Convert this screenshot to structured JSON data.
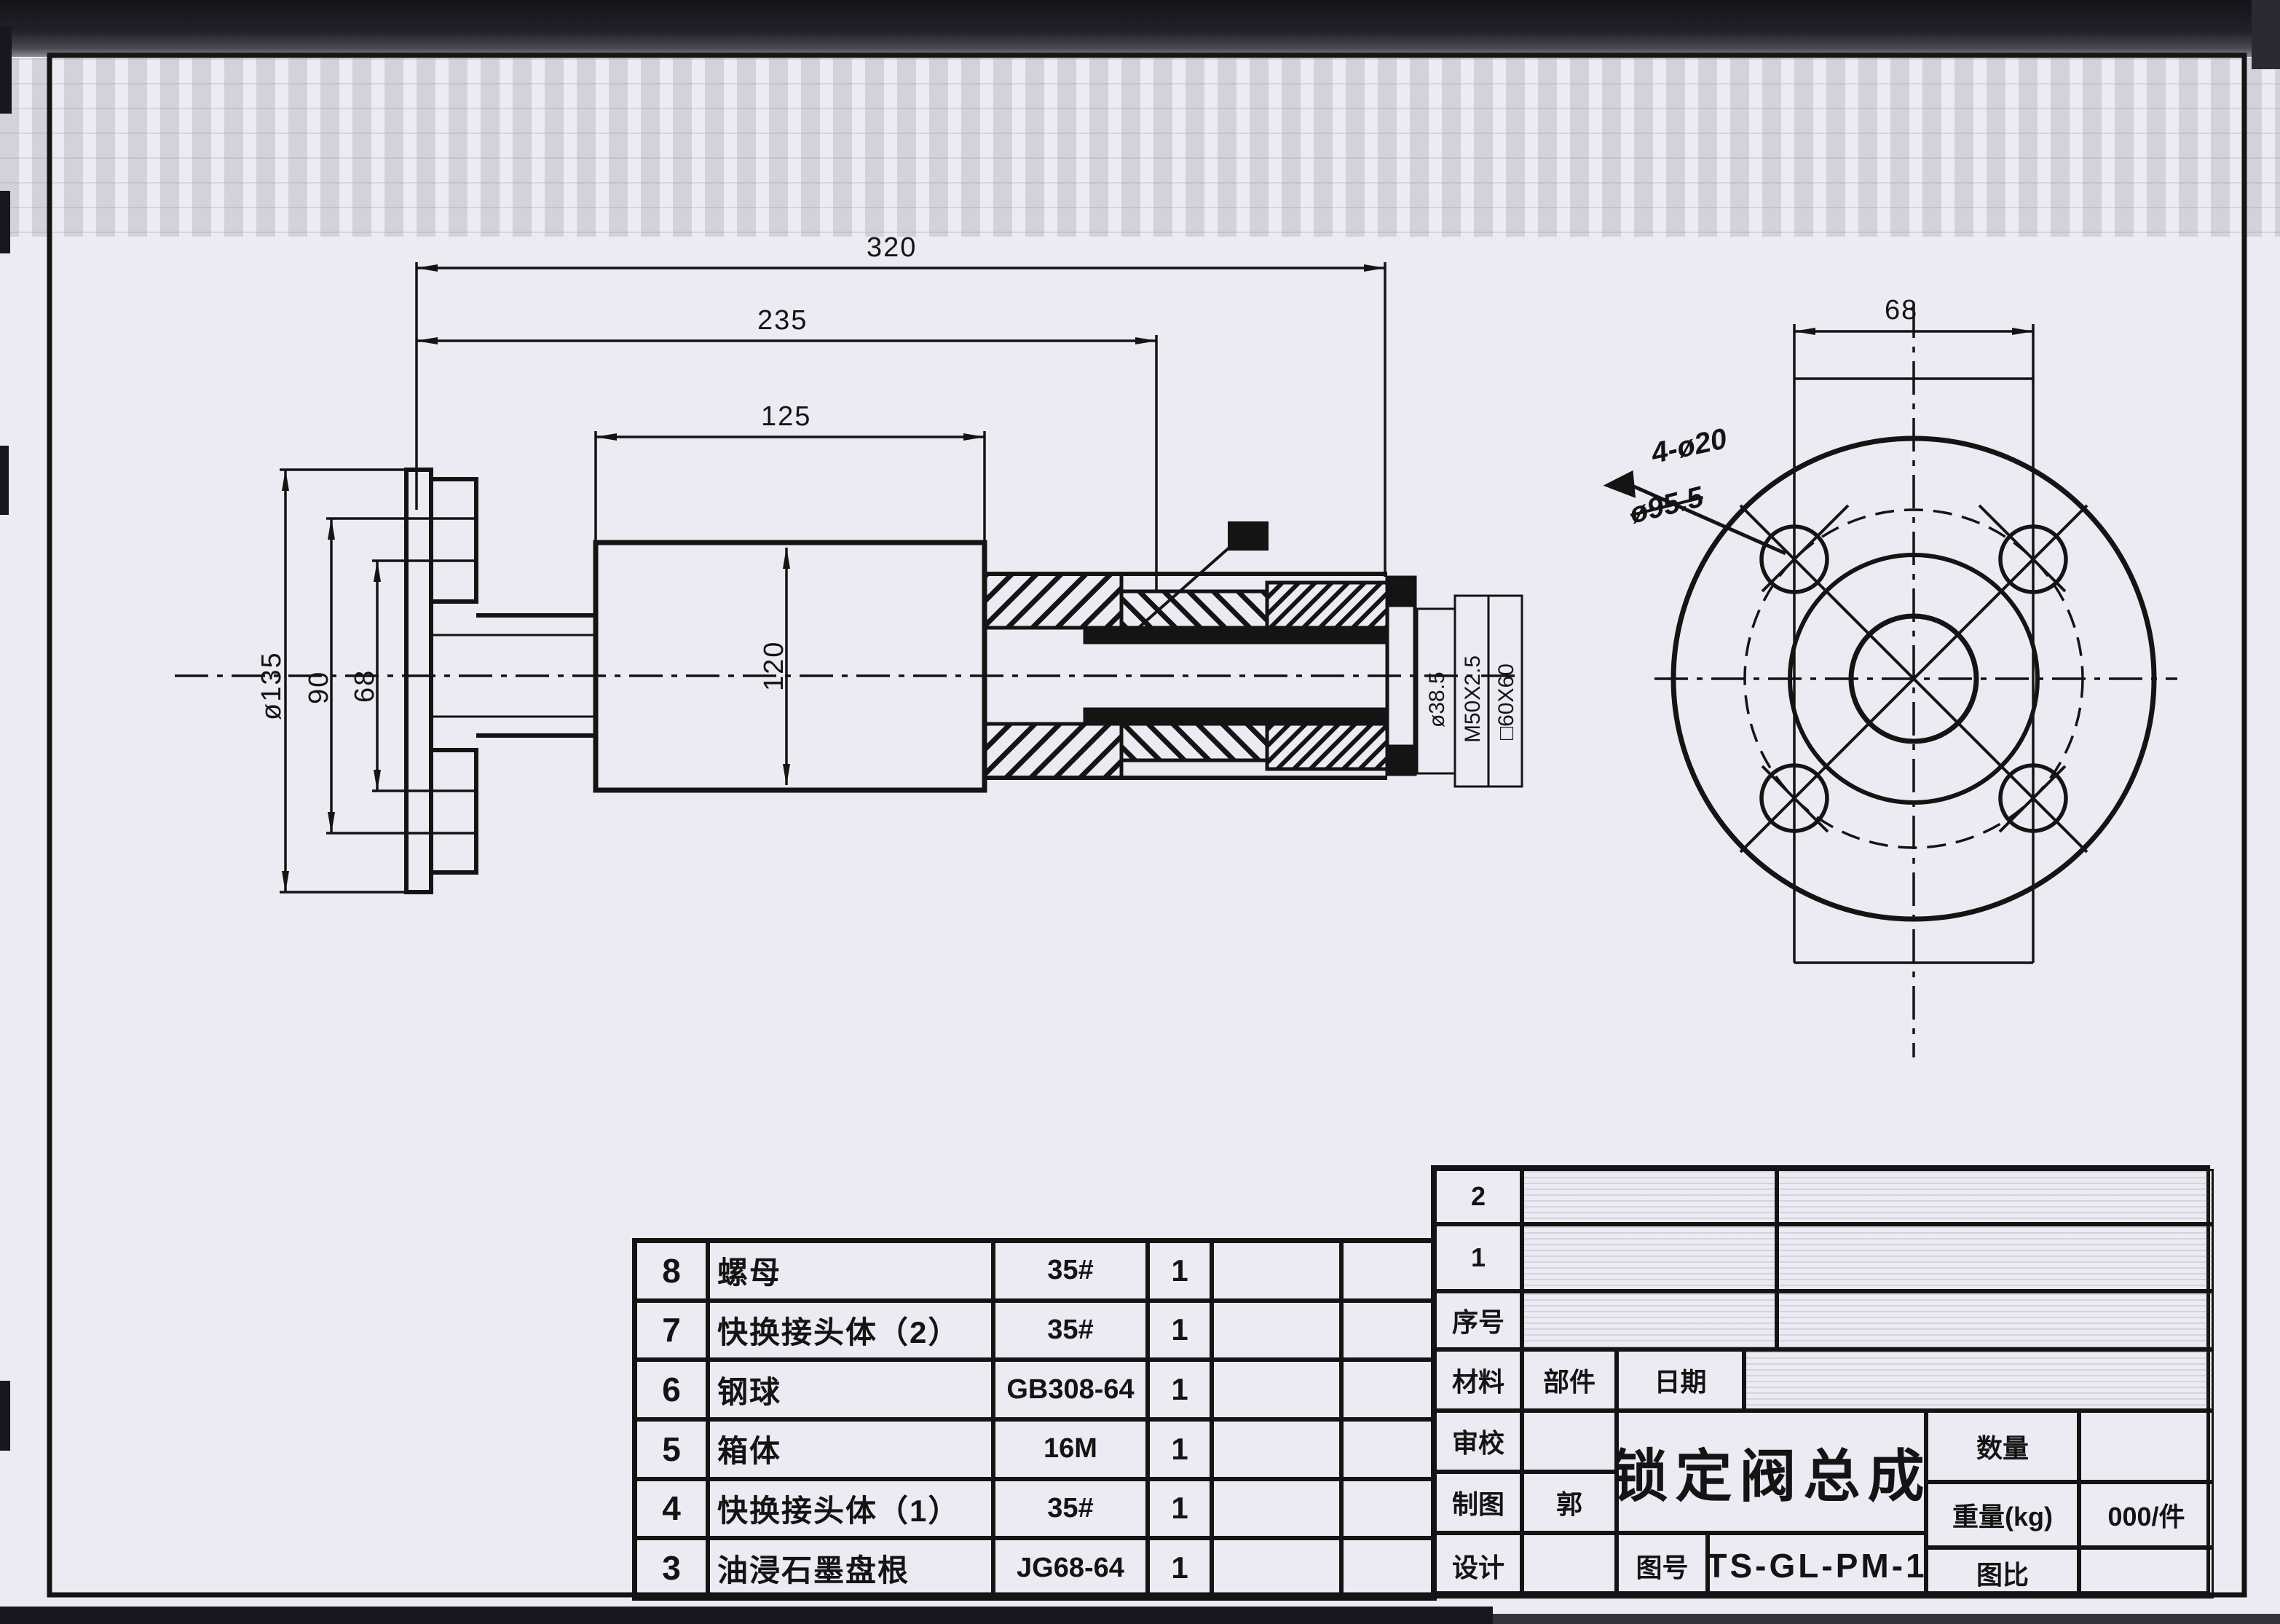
{
  "side_view": {
    "dim_320": "320",
    "dim_235": "235",
    "dim_125": "125",
    "dim_120": "120",
    "dim_d135": "ø135",
    "dim_90": "90",
    "dim_68": "68",
    "dim_d385": "ø38.5",
    "dim_m50": "M50X2.5",
    "dim_sq60": "□60X60",
    "label_m8": "M8"
  },
  "front_view": {
    "dim_68": "68",
    "note_holes": "4-ø20",
    "note_struck": "ø95.5"
  },
  "parts_table": {
    "rows": [
      {
        "no": "8",
        "name": "螺母",
        "spec": "35#",
        "qty": "1"
      },
      {
        "no": "7",
        "name": "快换接头体（2）",
        "spec": "35#",
        "qty": "1"
      },
      {
        "no": "6",
        "name": "钢球",
        "spec": "GB308-64",
        "qty": "1"
      },
      {
        "no": "5",
        "name": "箱体",
        "spec": "16M",
        "qty": "1"
      },
      {
        "no": "4",
        "name": "快换接头体（1）",
        "spec": "35#",
        "qty": "1"
      },
      {
        "no": "3",
        "name": "油浸石墨盘根",
        "spec": "JG68-64",
        "qty": "1"
      }
    ]
  },
  "title_block": {
    "serial_2": "2",
    "serial_1": "1",
    "serial_label": "序号",
    "material_label": "材料",
    "part_label": "部件",
    "date_label": "日期",
    "review_label": "审校",
    "draft_label": "制图",
    "draft_value": "郭",
    "design_label": "设计",
    "title": "锁定阀总成",
    "qty_label": "数量",
    "qty_value": "",
    "weight_label": "重量(kg)",
    "weight_value": "000/件",
    "scale_label": "图比",
    "scale_value": "",
    "drawing_no_label": "图号",
    "drawing_no": "TS-GL-PM-1"
  }
}
